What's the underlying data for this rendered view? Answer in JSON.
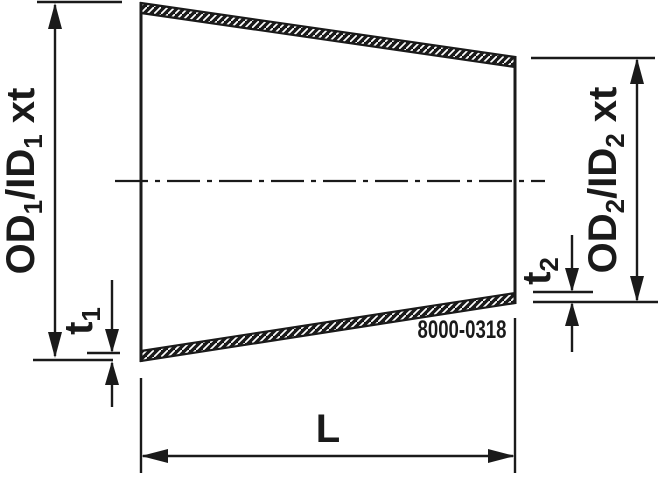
{
  "part_number": "8000-0318",
  "labels": {
    "od1": {
      "p1": "OD",
      "s1": "1",
      "p2": "/ID",
      "s2": "1",
      "p3": "xt"
    },
    "od2": {
      "p1": "OD",
      "s1": "2",
      "p2": "/ID",
      "s2": "2",
      "p3": "xt"
    },
    "t1": {
      "p": "t",
      "s": "1"
    },
    "t2": {
      "p": "t",
      "s": "2"
    },
    "length": "L"
  },
  "colors": {
    "line": "#1a1a1a",
    "background": "#ffffff"
  }
}
